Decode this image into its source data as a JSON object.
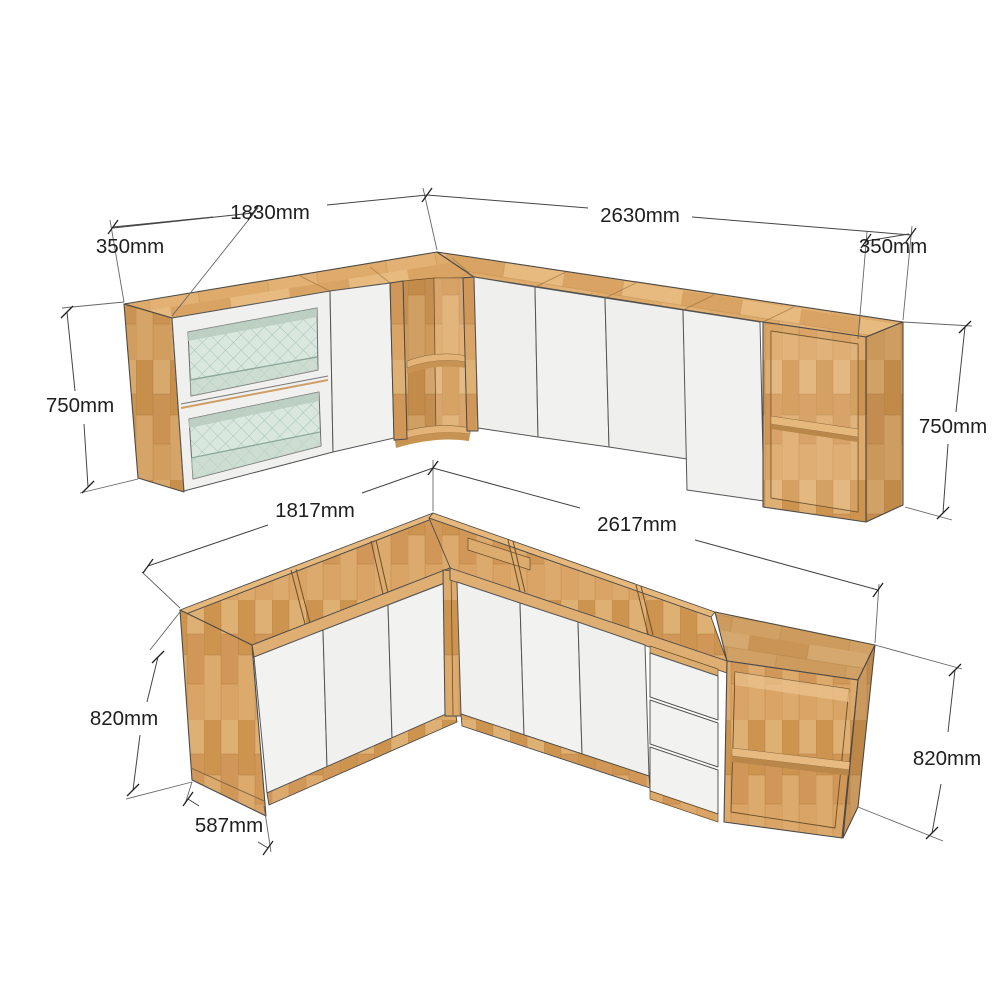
{
  "diagram": {
    "description": "L-shaped kitchen cabinet set shown as two 3D perspective views (wall cabinets above, base cabinets below) with dimension annotations",
    "units": "mm",
    "background": "#ffffff",
    "wall_cabinets": {
      "dim_width_left": "1830mm",
      "dim_width_right": "2630mm",
      "dim_depth_left": "350mm",
      "dim_depth_right": "350mm",
      "dim_height_left": "750mm",
      "dim_height_right": "750mm",
      "features": [
        "two stacked glass doors",
        "plain white door",
        "open corner shelf unit",
        "four white doors",
        "open end shelf unit"
      ]
    },
    "base_cabinets": {
      "dim_width_left": "1817mm",
      "dim_width_right": "2617mm",
      "dim_height_left": "820mm",
      "dim_height_right": "820mm",
      "dim_depth": "587mm",
      "features": [
        "open box tops",
        "three white doors left run",
        "three white doors right run",
        "three drawers",
        "open end shelf unit"
      ]
    },
    "colors": {
      "wood_light": "#e2b173",
      "wood_medium": "#d7a161",
      "wood_dark": "#c18a4a",
      "door_white": "#f1f1f0",
      "glass_teal": "#d9e7de",
      "dimension_line": "#3c3c3c",
      "dimension_text": "#1e1e1e"
    }
  }
}
